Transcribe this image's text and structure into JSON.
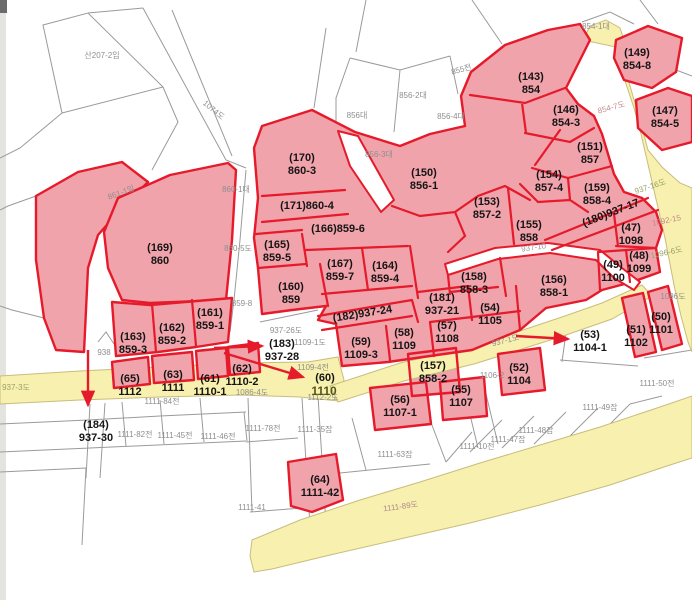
{
  "map": {
    "colors": {
      "highlight_fill": "#f1a3ab",
      "highlight_stroke": "#e51a2b",
      "road_fill": "#f7f0ae",
      "road_edge": "#c8bd7c",
      "parcel_line": "#9a9a9a",
      "label_ink": "#151515",
      "faint_label": "#8e8e8e"
    },
    "parcel_labels": [
      {
        "code": "(143)",
        "lot": "854",
        "x": 531,
        "y": 80
      },
      {
        "code": "(149)",
        "lot": "854-8",
        "x": 637,
        "y": 56
      },
      {
        "code": "(146)",
        "lot": "854-3",
        "x": 566,
        "y": 113
      },
      {
        "code": "(147)",
        "lot": "854-5",
        "x": 665,
        "y": 114
      },
      {
        "code": "(151)",
        "lot": "857",
        "x": 590,
        "y": 150
      },
      {
        "code": "(154)",
        "lot": "857-4",
        "x": 549,
        "y": 178
      },
      {
        "code": "(159)",
        "lot": "858-4",
        "x": 597,
        "y": 191
      },
      {
        "code": "(153)",
        "lot": "857-2",
        "x": 487,
        "y": 205
      },
      {
        "code": "(155)",
        "lot": "858",
        "x": 529,
        "y": 228
      },
      {
        "code": "(180)937-17",
        "lot": "",
        "x": 612,
        "y": 216,
        "rotate": -21
      },
      {
        "code": "(150)",
        "lot": "856-1",
        "x": 424,
        "y": 176
      },
      {
        "code": "(170)",
        "lot": "860-3",
        "x": 302,
        "y": 161
      },
      {
        "code": "(171)860-4",
        "lot": "",
        "x": 307,
        "y": 209
      },
      {
        "code": "(166)859-6",
        "lot": "",
        "x": 338,
        "y": 232
      },
      {
        "code": "(165)",
        "lot": "859-5",
        "x": 277,
        "y": 248
      },
      {
        "code": "(167)",
        "lot": "859-7",
        "x": 340,
        "y": 267
      },
      {
        "code": "(164)",
        "lot": "859-4",
        "x": 385,
        "y": 269
      },
      {
        "code": "(160)",
        "lot": "859",
        "x": 291,
        "y": 290
      },
      {
        "code": "(169)",
        "lot": "860",
        "x": 160,
        "y": 251
      },
      {
        "code": "(161)",
        "lot": "859-1",
        "x": 210,
        "y": 316
      },
      {
        "code": "(162)",
        "lot": "859-2",
        "x": 172,
        "y": 331
      },
      {
        "code": "(163)",
        "lot": "859-3",
        "x": 133,
        "y": 340
      },
      {
        "code": "(158)",
        "lot": "858-3",
        "x": 474,
        "y": 280
      },
      {
        "code": "(156)",
        "lot": "858-1",
        "x": 554,
        "y": 283
      },
      {
        "code": "(47)",
        "lot": "1098",
        "x": 631,
        "y": 231
      },
      {
        "code": "(48)",
        "lot": "1099",
        "x": 639,
        "y": 259
      },
      {
        "code": "(49)",
        "lot": "1100",
        "x": 613,
        "y": 268
      },
      {
        "code": "(181)",
        "lot": "937-21",
        "x": 442,
        "y": 301
      },
      {
        "code": "(54)",
        "lot": "1105",
        "x": 490,
        "y": 311
      },
      {
        "code": "(57)",
        "lot": "1108",
        "x": 447,
        "y": 329
      },
      {
        "code": "(58)",
        "lot": "1109",
        "x": 404,
        "y": 336
      },
      {
        "code": "(59)",
        "lot": "1109-3",
        "x": 361,
        "y": 345
      },
      {
        "code": "(182)937-24",
        "lot": "",
        "x": 363,
        "y": 317,
        "rotate": -9
      },
      {
        "code": "(53)",
        "lot": "1104-1",
        "x": 590,
        "y": 338
      },
      {
        "code": "(51)",
        "lot": "1102",
        "x": 636,
        "y": 333
      },
      {
        "code": "(50)",
        "lot": "1101",
        "x": 661,
        "y": 320
      },
      {
        "code": "(52)",
        "lot": "1104",
        "x": 519,
        "y": 371
      },
      {
        "code": "(157)",
        "lot": "858-2",
        "x": 433,
        "y": 369
      },
      {
        "code": "(55)",
        "lot": "1107",
        "x": 461,
        "y": 393
      },
      {
        "code": "(56)",
        "lot": "1107-1",
        "x": 400,
        "y": 403
      },
      {
        "code": "(64)",
        "lot": "1111-42",
        "x": 320,
        "y": 483
      },
      {
        "code": "(184)",
        "lot": "937-30",
        "x": 96,
        "y": 428
      },
      {
        "code": "(183)",
        "lot": "937-28",
        "x": 282,
        "y": 347
      },
      {
        "code": "(60)",
        "lot": "",
        "x": 325,
        "y": 381
      },
      {
        "code": "(62)",
        "lot": "1110-2",
        "x": 242,
        "y": 372
      },
      {
        "code": "(61)",
        "lot": "1110-1",
        "x": 210,
        "y": 382
      },
      {
        "code": "(63)",
        "lot": "1111",
        "x": 173,
        "y": 378
      },
      {
        "code": "(65)",
        "lot": "1112",
        "x": 130,
        "y": 382
      }
    ],
    "background_labels": [
      {
        "text": "산207-2임",
        "x": 102,
        "y": 58
      },
      {
        "text": "1074도",
        "x": 212,
        "y": 112,
        "rotate": 40
      },
      {
        "text": "855전",
        "x": 462,
        "y": 72,
        "rotate": -15
      },
      {
        "text": "854-1대",
        "x": 596,
        "y": 29
      },
      {
        "text": "856대",
        "x": 357,
        "y": 118
      },
      {
        "text": "856-2대",
        "x": 413,
        "y": 98
      },
      {
        "text": "856-4대",
        "x": 451,
        "y": 119
      },
      {
        "text": "856-3대",
        "x": 379,
        "y": 157
      },
      {
        "text": "861-1임",
        "x": 122,
        "y": 195,
        "rotate": -20
      },
      {
        "text": "860-1대",
        "x": 236,
        "y": 192
      },
      {
        "text": "860-5도",
        "x": 238,
        "y": 251
      },
      {
        "text": "859-8",
        "x": 242,
        "y": 306
      },
      {
        "text": "938",
        "x": 104,
        "y": 355
      },
      {
        "text": "937-26도",
        "x": 286,
        "y": 333
      },
      {
        "text": "1109-1도",
        "x": 310,
        "y": 345
      },
      {
        "text": "1109-4전",
        "x": 313,
        "y": 370
      },
      {
        "text": "1086-4도",
        "x": 252,
        "y": 395
      },
      {
        "text": "1112-2도",
        "x": 323,
        "y": 400
      },
      {
        "text": "1111-84전",
        "x": 162,
        "y": 404
      },
      {
        "text": "1111-82전",
        "x": 135,
        "y": 437
      },
      {
        "text": "1111-45전",
        "x": 175,
        "y": 438
      },
      {
        "text": "1111-46전",
        "x": 218,
        "y": 439
      },
      {
        "text": "1111-78전",
        "x": 263,
        "y": 431
      },
      {
        "text": "1111-35잡",
        "x": 315,
        "y": 432
      },
      {
        "text": "1111-63잡",
        "x": 395,
        "y": 457
      },
      {
        "text": "1111-41",
        "x": 252,
        "y": 510
      },
      {
        "text": "1111-49잡",
        "x": 600,
        "y": 410
      },
      {
        "text": "1111-48잡",
        "x": 536,
        "y": 433
      },
      {
        "text": "1111-47잡",
        "x": 508,
        "y": 442
      },
      {
        "text": "1111-10전",
        "x": 477,
        "y": 449
      },
      {
        "text": "1111-50전",
        "x": 657,
        "y": 386
      },
      {
        "text": "1106-2",
        "x": 492,
        "y": 378
      }
    ],
    "road_labels": [
      {
        "text": "1110",
        "x": 324,
        "y": 395,
        "color": "#55551a",
        "size": 12,
        "weight": 700
      },
      {
        "text": "854-7도",
        "x": 612,
        "y": 110,
        "color": "#c09090",
        "size": 8,
        "rotate": -15
      },
      {
        "text": "1092-15",
        "x": 667,
        "y": 223,
        "color": "#c08888",
        "size": 8,
        "rotate": -12
      },
      {
        "text": "937-16도",
        "x": 651,
        "y": 189,
        "color": "#9aa06a",
        "size": 8,
        "rotate": -18
      },
      {
        "text": "1096-6도",
        "x": 667,
        "y": 255,
        "color": "#9aa06a",
        "size": 8,
        "rotate": -12
      },
      {
        "text": "1096도",
        "x": 673,
        "y": 299,
        "color": "#909090",
        "size": 8
      },
      {
        "text": "1111-89도",
        "x": 401,
        "y": 509,
        "color": "#b08888",
        "size": 8,
        "rotate": -8
      },
      {
        "text": "937-1도",
        "x": 506,
        "y": 343,
        "color": "#8f8f8f",
        "size": 8,
        "rotate": -14
      },
      {
        "text": "937-3도",
        "x": 16,
        "y": 390,
        "color": "#9aa06a",
        "size": 8
      },
      {
        "text": "937-10",
        "x": 534,
        "y": 250,
        "color": "#9a9a9a",
        "size": 8,
        "rotate": -8
      }
    ],
    "arrows": [
      {
        "x1": 214,
        "y1": 348,
        "x2": 262,
        "y2": 346
      },
      {
        "x1": 224,
        "y1": 353,
        "x2": 303,
        "y2": 377
      },
      {
        "x1": 88,
        "y1": 350,
        "x2": 88,
        "y2": 405
      },
      {
        "x1": 516,
        "y1": 336,
        "x2": 568,
        "y2": 339
      }
    ]
  }
}
